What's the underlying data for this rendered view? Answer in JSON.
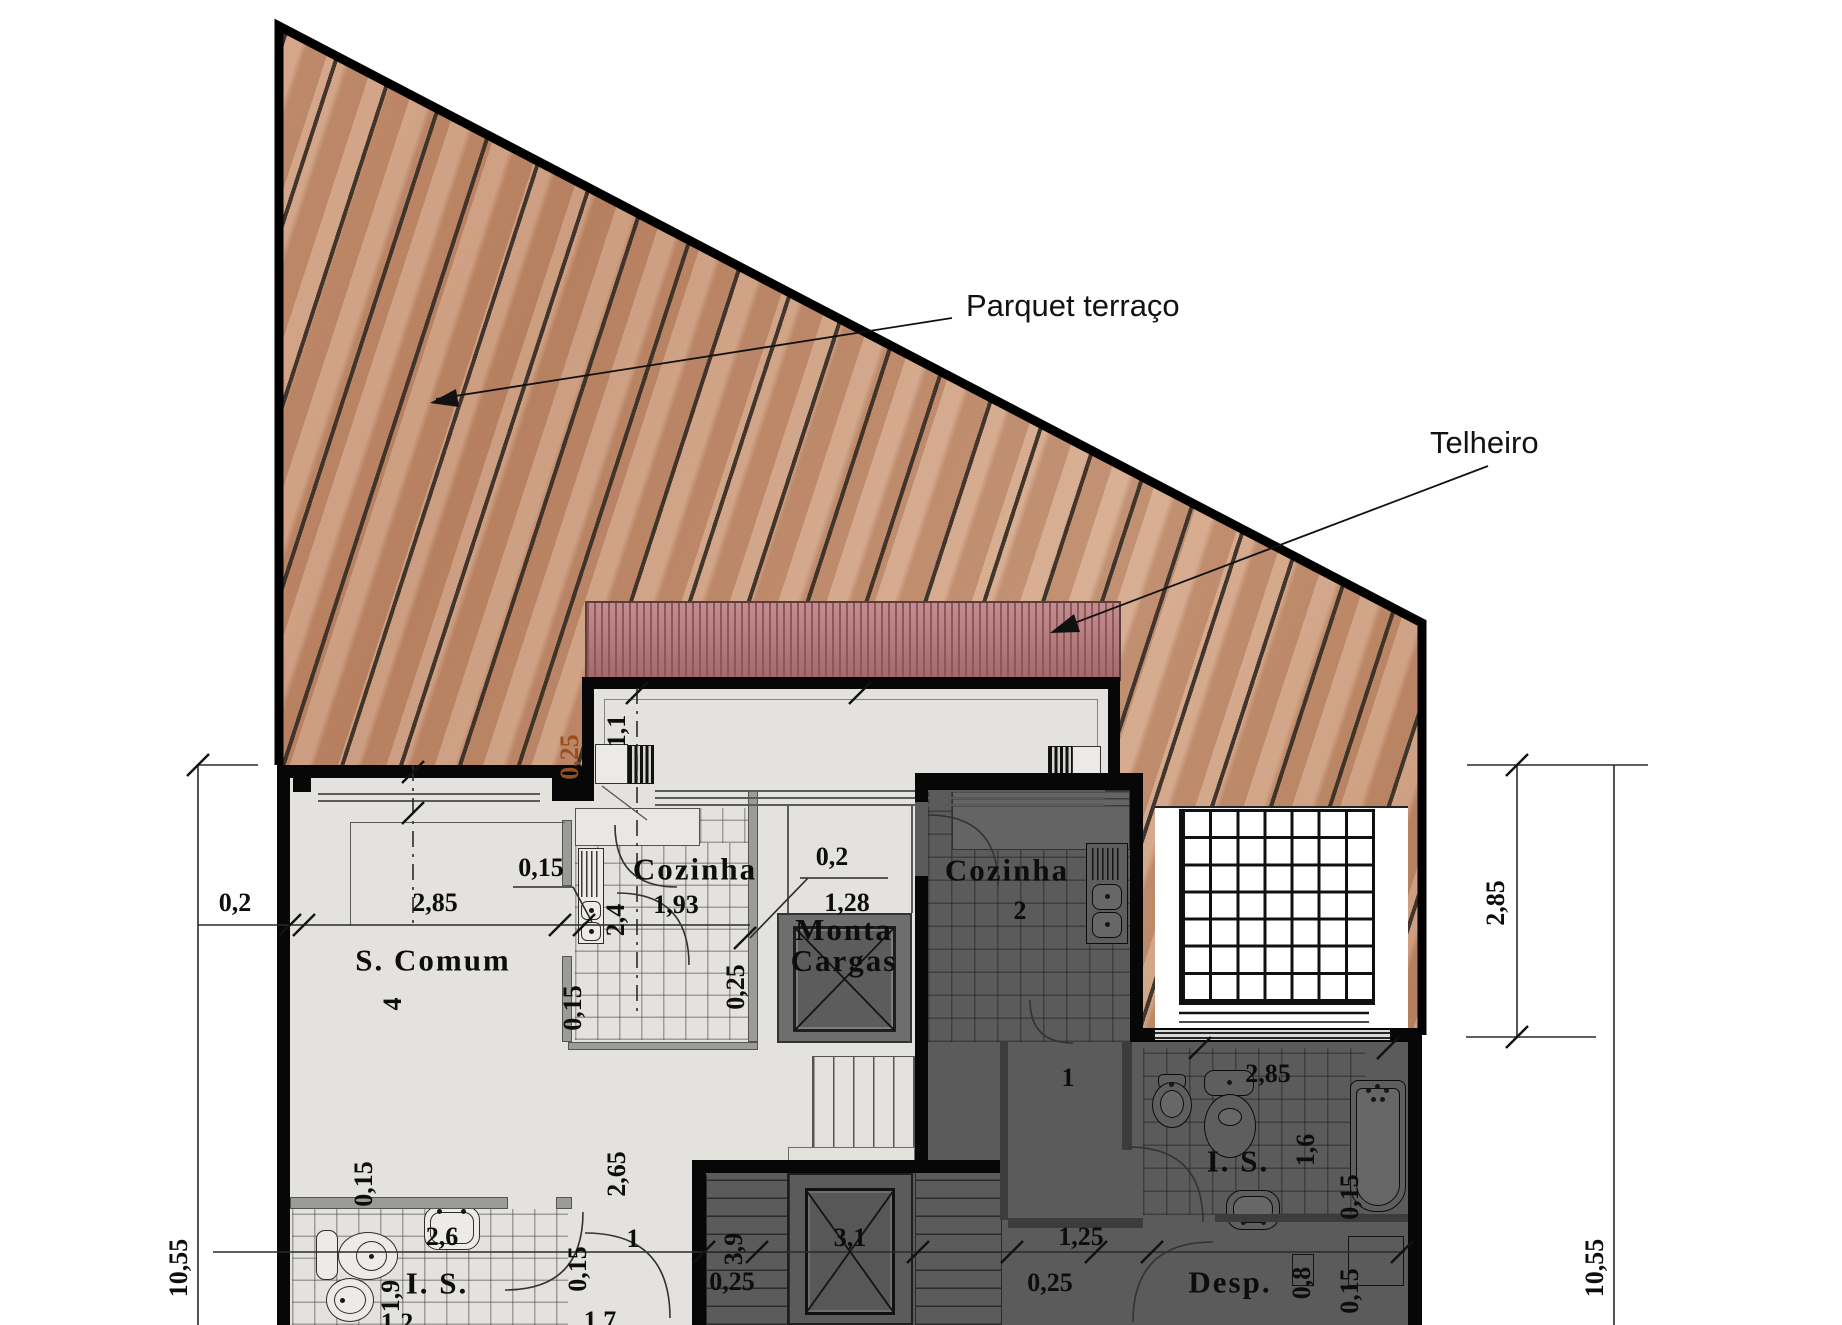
{
  "annotations": {
    "parquet": "Parquet terraço",
    "telheiro": "Telheiro"
  },
  "room_labels": [
    {
      "t": "S. Comum",
      "x": 433,
      "y": 960
    },
    {
      "t": "Cozinha",
      "x": 695,
      "y": 869
    },
    {
      "t": "Cozinha",
      "x": 1007,
      "y": 870
    },
    {
      "t": "Monta\nCargas",
      "x": 844,
      "y": 945
    },
    {
      "t": "I. S.",
      "x": 437,
      "y": 1283
    },
    {
      "t": "I. S.",
      "x": 1238,
      "y": 1161
    },
    {
      "t": "Desp.",
      "x": 1230,
      "y": 1282
    }
  ],
  "dim_labels": [
    {
      "t": "0,2",
      "x": 235,
      "y": 903
    },
    {
      "t": "2,85",
      "x": 435,
      "y": 903
    },
    {
      "t": "0,15",
      "x": 541,
      "y": 868
    },
    {
      "t": "4",
      "x": 393,
      "y": 1004,
      "r": 1
    },
    {
      "t": "0,25",
      "x": 570,
      "y": 757,
      "r": 1,
      "accent": true
    },
    {
      "t": "1,1",
      "x": 617,
      "y": 731,
      "r": 1
    },
    {
      "t": "1,93",
      "x": 676,
      "y": 905
    },
    {
      "t": "2,4",
      "x": 616,
      "y": 920,
      "r": 1
    },
    {
      "t": "0,2",
      "x": 832,
      "y": 857
    },
    {
      "t": "1,28",
      "x": 847,
      "y": 903
    },
    {
      "t": "0,25",
      "x": 736,
      "y": 987,
      "r": 1
    },
    {
      "t": "0,15",
      "x": 573,
      "y": 1008,
      "r": 1
    },
    {
      "t": "2",
      "x": 1020,
      "y": 911
    },
    {
      "t": "0,15",
      "x": 364,
      "y": 1184,
      "r": 1
    },
    {
      "t": "2,6",
      "x": 442,
      "y": 1237
    },
    {
      "t": "1,9",
      "x": 391,
      "y": 1296,
      "r": 1
    },
    {
      "t": "2,65",
      "x": 617,
      "y": 1174,
      "r": 1
    },
    {
      "t": "1",
      "x": 633,
      "y": 1239
    },
    {
      "t": "0,15",
      "x": 578,
      "y": 1269,
      "r": 1
    },
    {
      "t": "3,9",
      "x": 734,
      "y": 1249,
      "r": 1
    },
    {
      "t": "0,25",
      "x": 732,
      "y": 1282
    },
    {
      "t": "3,1",
      "x": 850,
      "y": 1238
    },
    {
      "t": "1",
      "x": 1068,
      "y": 1078
    },
    {
      "t": "2,85",
      "x": 1268,
      "y": 1074
    },
    {
      "t": "1,6",
      "x": 1306,
      "y": 1150,
      "r": 1
    },
    {
      "t": "0,15",
      "x": 1350,
      "y": 1197,
      "r": 1
    },
    {
      "t": "1,25",
      "x": 1081,
      "y": 1237
    },
    {
      "t": "0,25",
      "x": 1050,
      "y": 1283
    },
    {
      "t": "0,8",
      "x": 1302,
      "y": 1283,
      "r": 1
    },
    {
      "t": "0,15",
      "x": 1350,
      "y": 1291,
      "r": 1
    },
    {
      "t": "10,55",
      "x": 179,
      "y": 1268,
      "r": 1
    },
    {
      "t": "2,85",
      "x": 1496,
      "y": 903,
      "r": 1
    },
    {
      "t": "10,55",
      "x": 1595,
      "y": 1268,
      "r": 1
    },
    {
      "t": "1,2",
      "x": 397,
      "y": 1323
    },
    {
      "t": "1,7",
      "x": 600,
      "y": 1321
    }
  ],
  "colors": {
    "deck_base": "#c99374",
    "roof_base": "#b57577",
    "roof_stripe": "#8f5558",
    "light_floor": "#e4e2df",
    "dark_floor": "#5b5b5b",
    "wall": "#070707",
    "accent_orange": "#99501f"
  }
}
